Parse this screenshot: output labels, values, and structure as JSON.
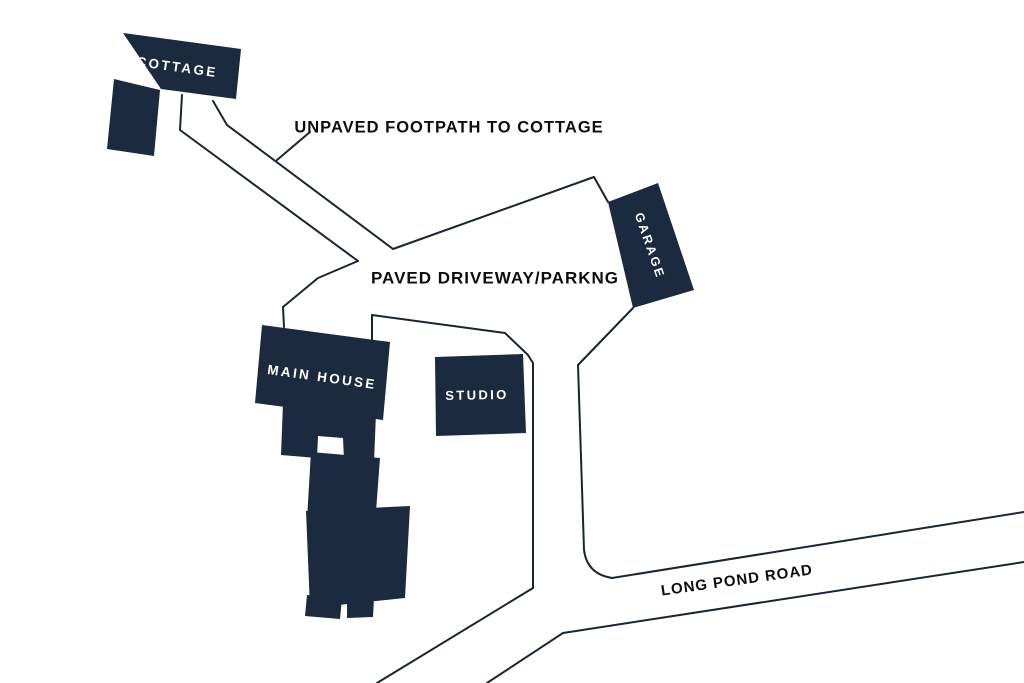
{
  "map": {
    "title": "Property site plan",
    "colors": {
      "background": "#ffffff",
      "building_fill": "#1b2a3e",
      "line_stroke": "#1a2433",
      "label_dark": "#0d0d0d",
      "label_light": "#ffffff"
    },
    "buildings": [
      {
        "id": "cottage",
        "label": "COTTAGE"
      },
      {
        "id": "garage",
        "label": "GARAGE"
      },
      {
        "id": "main_house",
        "label": "MAIN HOUSE"
      },
      {
        "id": "studio",
        "label": "STUDIO"
      }
    ],
    "ways": [
      {
        "id": "footpath",
        "label": "UNPAVED FOOTPATH TO COTTAGE"
      },
      {
        "id": "driveway",
        "label": "PAVED DRIVEWAY/PARKNG"
      },
      {
        "id": "road",
        "label": "LONG POND ROAD"
      }
    ]
  }
}
